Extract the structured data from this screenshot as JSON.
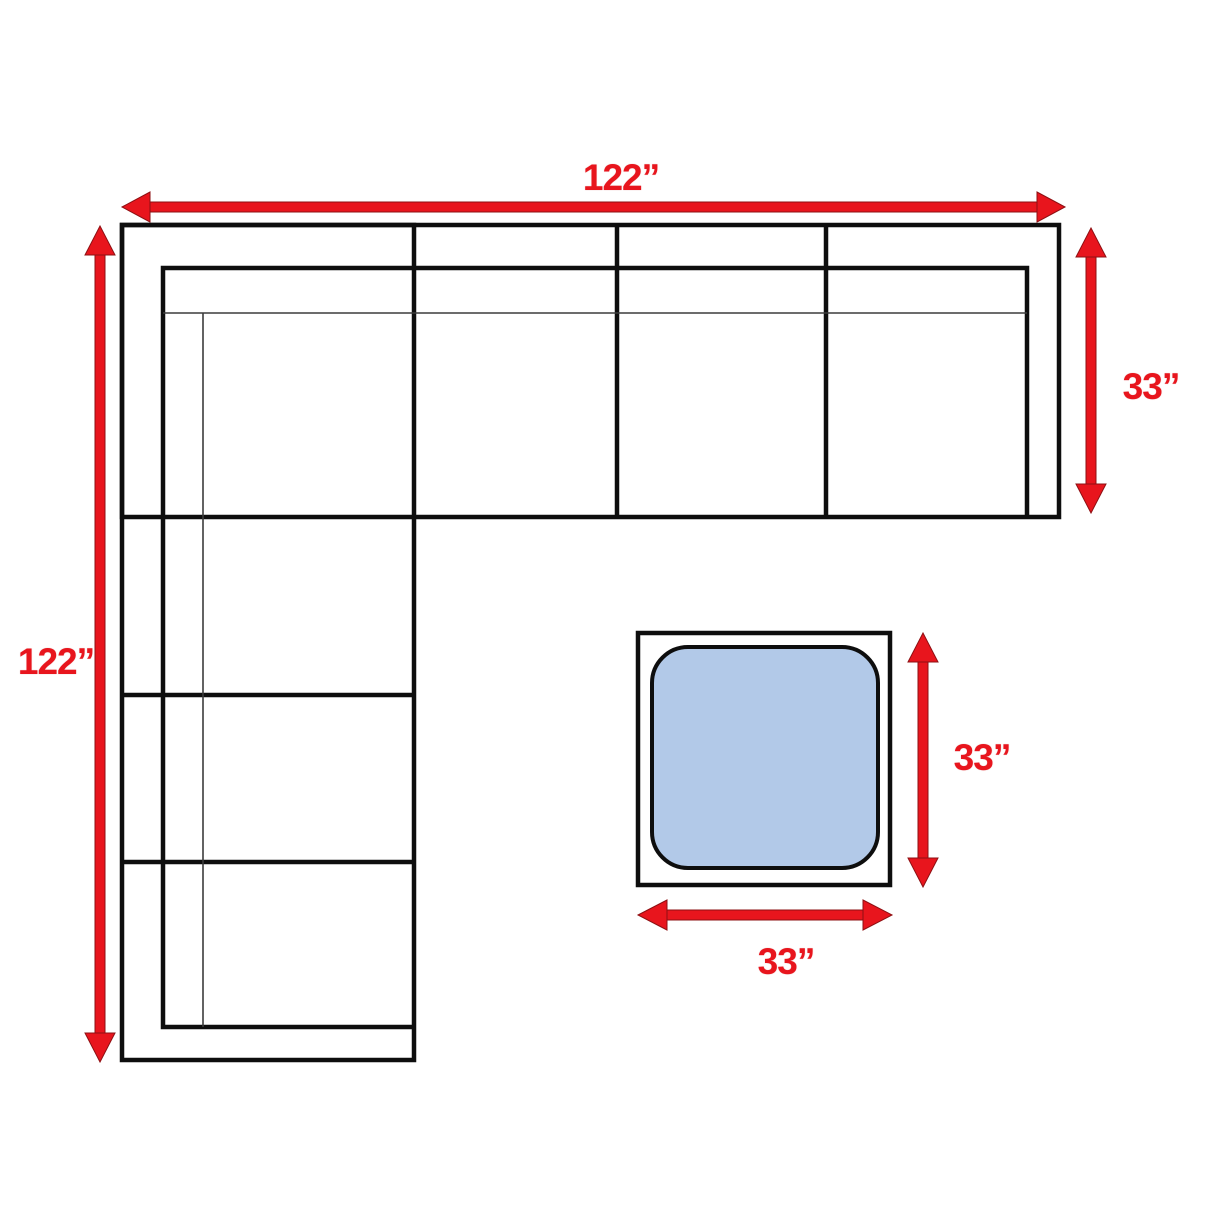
{
  "diagram": {
    "type": "sectional-sofa-dimension-diagram",
    "labels": {
      "overall_width": "122”",
      "overall_depth": "122”",
      "section_depth": "33”",
      "ottoman_depth": "33”",
      "ottoman_width": "33”"
    },
    "colors": {
      "dimension_red": "#e8151d",
      "outline_black": "#0e0e0e",
      "thin_line_gray": "#3c3c3c",
      "ottoman_fill": "#b2c9e8",
      "background": "#ffffff"
    }
  }
}
